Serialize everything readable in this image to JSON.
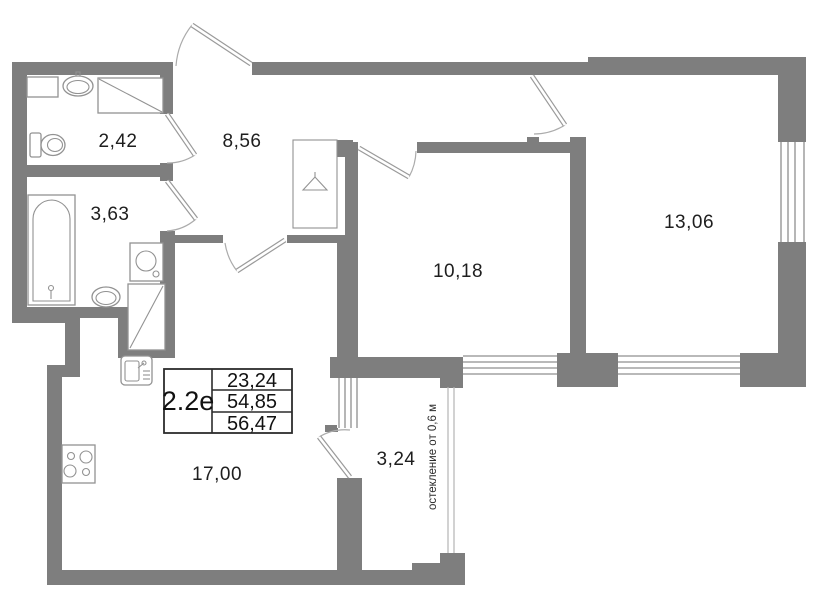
{
  "plan": {
    "type": "apartment-floor-plan"
  },
  "rooms": {
    "wc": {
      "area": "2,42"
    },
    "hallway": {
      "area": "8,56"
    },
    "bathroom": {
      "area": "3,63"
    },
    "bedroom": {
      "area": "10,18"
    },
    "living_room": {
      "area": "13,06"
    },
    "kitchen_living": {
      "area": "17,00"
    },
    "balcony": {
      "area": "3,24"
    }
  },
  "info_table": {
    "unit_type": "2.2е",
    "values": [
      "23,24",
      "54,85",
      "56,47"
    ]
  },
  "annotations": {
    "glazing_note": "остекление от 0,6 м"
  },
  "fixture_icons": [
    "toilet-icon",
    "washbasin-icon",
    "shelf-icon",
    "shower-tray-icon",
    "bathtub-icon",
    "washing-machine-icon",
    "sink-icon",
    "vent-shaft-icon",
    "kitchen-sink-icon",
    "stove-icon",
    "wardrobe-hanger-icon"
  ],
  "colors": {
    "wall": "#7e7e7e",
    "line": "#8f8f8f",
    "text": "#1e1e1e",
    "table_border": "#2c2c2c",
    "bg": "#ffffff"
  }
}
